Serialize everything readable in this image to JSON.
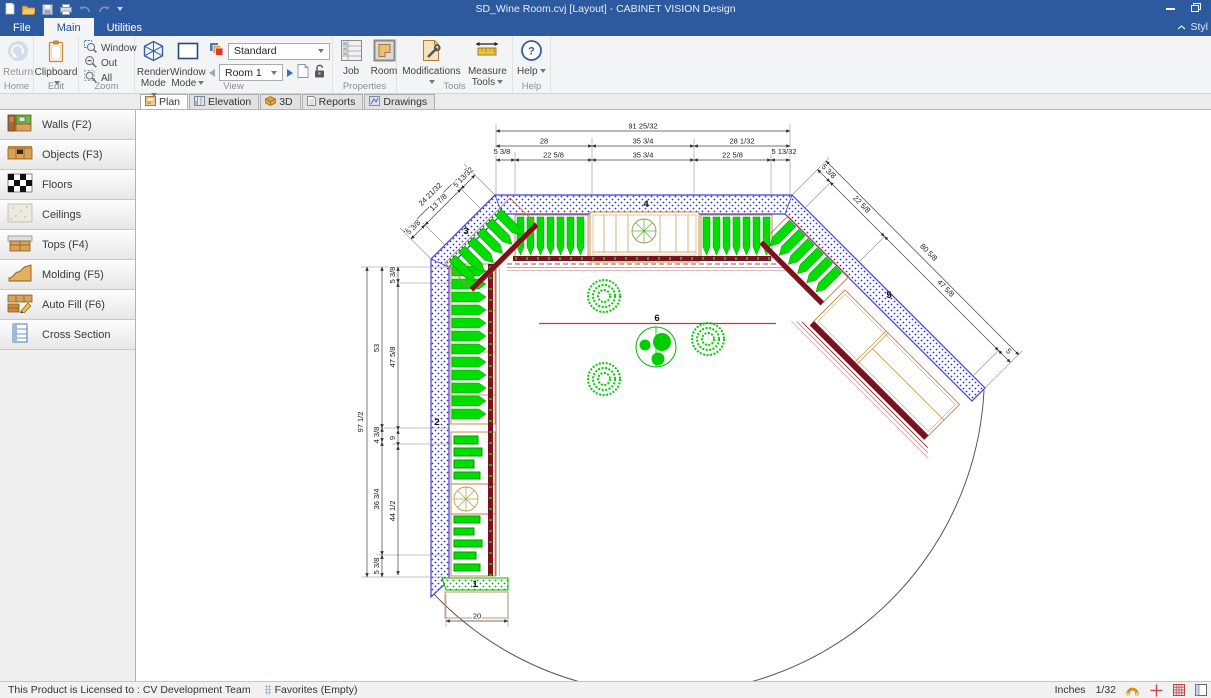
{
  "window": {
    "title": "SD_Wine Room.cvj [Layout] - CABINET VISION Design"
  },
  "menu": {
    "tabs": [
      "File",
      "Main",
      "Utilities"
    ],
    "style_label": "Styl"
  },
  "ribbon": {
    "groups": {
      "home": {
        "caption": "Home",
        "return_label": "Return"
      },
      "edit": {
        "caption": "Edit",
        "clipboard_label": "Clipboard"
      },
      "zoom": {
        "caption": "Zoom",
        "items": [
          "Window",
          "Out",
          "All"
        ]
      },
      "view": {
        "caption": "View",
        "render_label": "Render Mode",
        "window_label": "Window Mode",
        "standard_value": "Standard",
        "room_value": "Room 1"
      },
      "properties": {
        "caption": "Properties",
        "job_label": "Job",
        "room_label": "Room"
      },
      "tools": {
        "caption": "Tools",
        "modifications_label": "Modifications",
        "measure_label": "Measure Tools"
      },
      "help": {
        "caption": "Help",
        "help_label": "Help"
      }
    }
  },
  "doc_tabs": [
    {
      "label": "Plan"
    },
    {
      "label": "Elevation"
    },
    {
      "label": "3D"
    },
    {
      "label": "Reports"
    },
    {
      "label": "Drawings"
    }
  ],
  "sidebar": {
    "items": [
      {
        "label": "Walls (F2)"
      },
      {
        "label": "Objects (F3)"
      },
      {
        "label": "Floors"
      },
      {
        "label": "Ceilings"
      },
      {
        "label": "Tops (F4)"
      },
      {
        "label": "Molding (F5)"
      },
      {
        "label": "Auto Fill (F6)"
      },
      {
        "label": "Cross Section"
      }
    ]
  },
  "statusbar": {
    "license": "This Product is Licensed to : CV Development Team",
    "favorites": "Favorites (Empty)",
    "units": "Inches",
    "scale": "1/32"
  },
  "drawing": {
    "wall_labels": {
      "w1": "1",
      "w2": "2",
      "w3": "3",
      "w4": "4",
      "w5": "5",
      "w6": "6"
    },
    "dims": {
      "top_total": "91 25/32",
      "top_row2": [
        "28",
        "35 3/4",
        "28 1/32"
      ],
      "top_row3": [
        "5 3/8",
        "22 5/8",
        "35 3/4",
        "22 5/8",
        "5 13/32"
      ],
      "left_total": "97 1/2",
      "left_col2": [
        "53",
        "4 3/8",
        "36 3/4",
        "5 3/8"
      ],
      "left_col3": [
        "5 3/8",
        "47 5/8",
        "9",
        "44 1/2"
      ],
      "wall3_total": "24 21/32",
      "wall3_segs": [
        "5 3/8",
        "13 7/8",
        "5 13/32"
      ],
      "wall5_total": "80 5/8",
      "wall5_segs": [
        "5 3/8",
        "22 5/8",
        "47 5/8",
        "5"
      ],
      "bottom": "20"
    }
  }
}
